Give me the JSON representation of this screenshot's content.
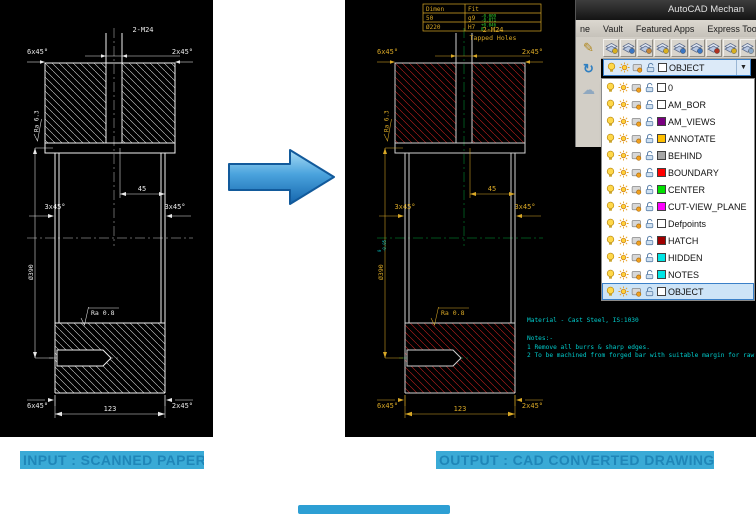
{
  "captions": {
    "input": "INPUT : SCANNED PAPER",
    "output": "OUTPUT : CAD CONVERTED DRAWING"
  },
  "drawing": {
    "thread_callout": "2-M24",
    "tapped_holes": "Tapped Holes",
    "chamfer_6x45": "6x45°",
    "chamfer_2x45": "2x45°",
    "chamfer_3x45": "3x45°",
    "ra_top": "Ra 6.3",
    "ra_bottom": "Ra 0.8",
    "dim_45": "45",
    "dim_123": "123",
    "dia_390": "Ø390",
    "dia_390_tol_upper": "0",
    "dia_390_tol_lower": "-0.05"
  },
  "fit_table": {
    "headers": [
      "Dimen",
      "Fit"
    ],
    "rows": [
      {
        "dimen": "50",
        "fit": "g9",
        "tol_upper": "-0.009",
        "tol_lower": "-0.071"
      },
      {
        "dimen": "Ø220",
        "fit": "H7",
        "tol_upper": "+0.046",
        "tol_lower": "0"
      }
    ]
  },
  "notes": {
    "material": "Material - Cast Steel, IS:1030",
    "heading": "Notes:-",
    "items": [
      "1   Remove all burrs & sharp edges.",
      "2   To be machined from forged bar with suitable margin for raw size"
    ]
  },
  "autocad": {
    "window_title": "AutoCAD Mechan",
    "menu_items": [
      "ne",
      "Vault",
      "Featured Apps",
      "Express Tools"
    ],
    "layer_combo_selected": "OBJECT",
    "toolbar_buttons": [
      {
        "name": "hatch-pencil-icon",
        "accent": "#d8b020"
      },
      {
        "name": "layer-manager-icon",
        "accent": "#3a76c4"
      },
      {
        "name": "layer-states-icon",
        "accent": "#c4873a"
      },
      {
        "name": "layer-previous-icon",
        "accent": "#d8b020"
      },
      {
        "name": "layer-isolate-icon",
        "accent": "#3a76c4"
      },
      {
        "name": "layer-unisolate-icon",
        "accent": "#3a76c4"
      },
      {
        "name": "layer-freeze-icon",
        "accent": "#b03020"
      },
      {
        "name": "layer-off-icon",
        "accent": "#d8b020"
      },
      {
        "name": "layer-lock-icon",
        "accent": "#88a8c8"
      }
    ],
    "layers": [
      {
        "name": "0",
        "color": "#ffffff"
      },
      {
        "name": "AM_BOR",
        "color": "#ffffff"
      },
      {
        "name": "AM_VIEWS",
        "color": "#7a0080"
      },
      {
        "name": "ANNOTATE",
        "color": "#ffbf00"
      },
      {
        "name": "BEHIND",
        "color": "#a6a6a6"
      },
      {
        "name": "BOUNDARY",
        "color": "#ff0000"
      },
      {
        "name": "CENTER",
        "color": "#00e000"
      },
      {
        "name": "CUT-VIEW_PLANE",
        "color": "#ff00ff"
      },
      {
        "name": "Defpoints",
        "color": "#ffffff"
      },
      {
        "name": "HATCH",
        "color": "#a00000"
      },
      {
        "name": "HIDDEN",
        "color": "#00e5e5"
      },
      {
        "name": "NOTES",
        "color": "#00e5e5"
      },
      {
        "name": "OBJECT",
        "color": "#ffffff",
        "selected": true
      }
    ]
  }
}
